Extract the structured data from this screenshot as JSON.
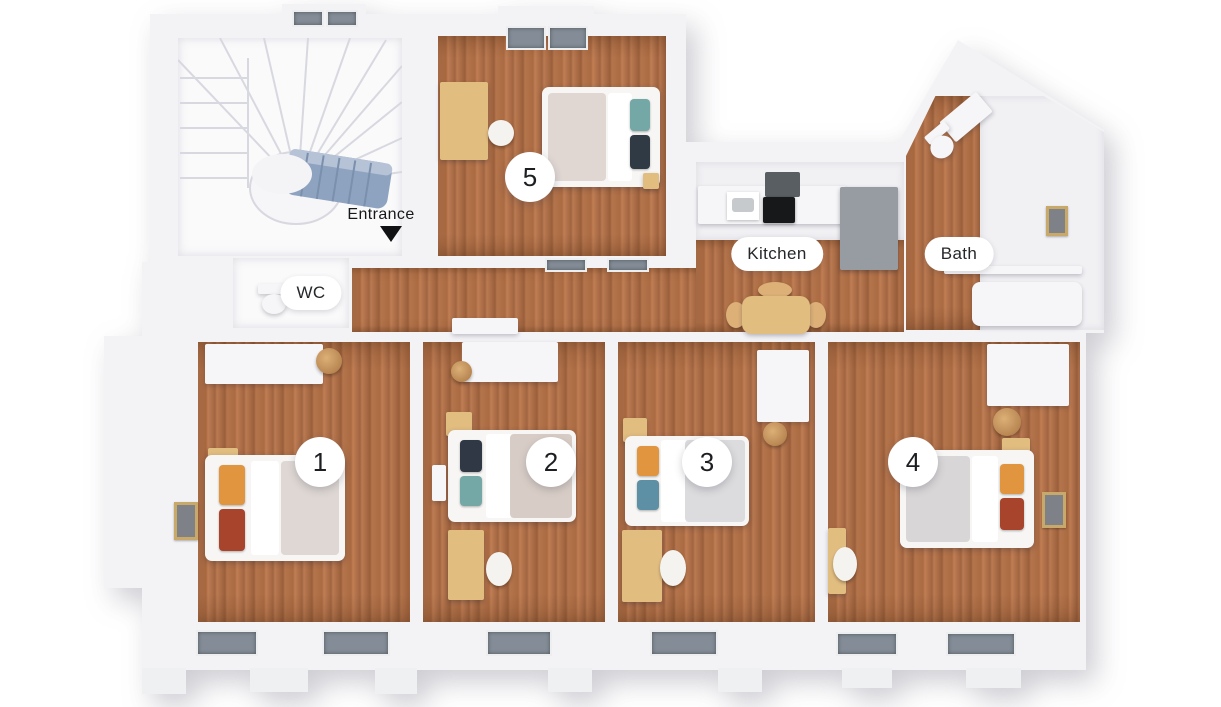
{
  "title": "3D floor plan with five numbered rooms",
  "labels": {
    "entrance": "Entrance",
    "wc": "WC",
    "kitchen": "Kitchen",
    "bath": "Bath"
  },
  "room_badges": [
    "1",
    "2",
    "3",
    "4",
    "5"
  ],
  "colors": {
    "background": "#ffffff",
    "wall": "#f3f3f6",
    "wall_shadow": "#d9dade",
    "floor_wood": "#b4754c",
    "floor_wood_dark": "#9a5f3b",
    "stair_accent_blue": "#8ea3c0",
    "counter_gray": "#969ca2",
    "furniture_tan": "#e2bd80",
    "pillow_orange": "#e2953f",
    "pillow_red": "#a8432c",
    "pillow_navy": "#303845",
    "pillow_teal": "#74a8a6",
    "label_bg": "#ffffff",
    "label_text": "#25272a"
  }
}
